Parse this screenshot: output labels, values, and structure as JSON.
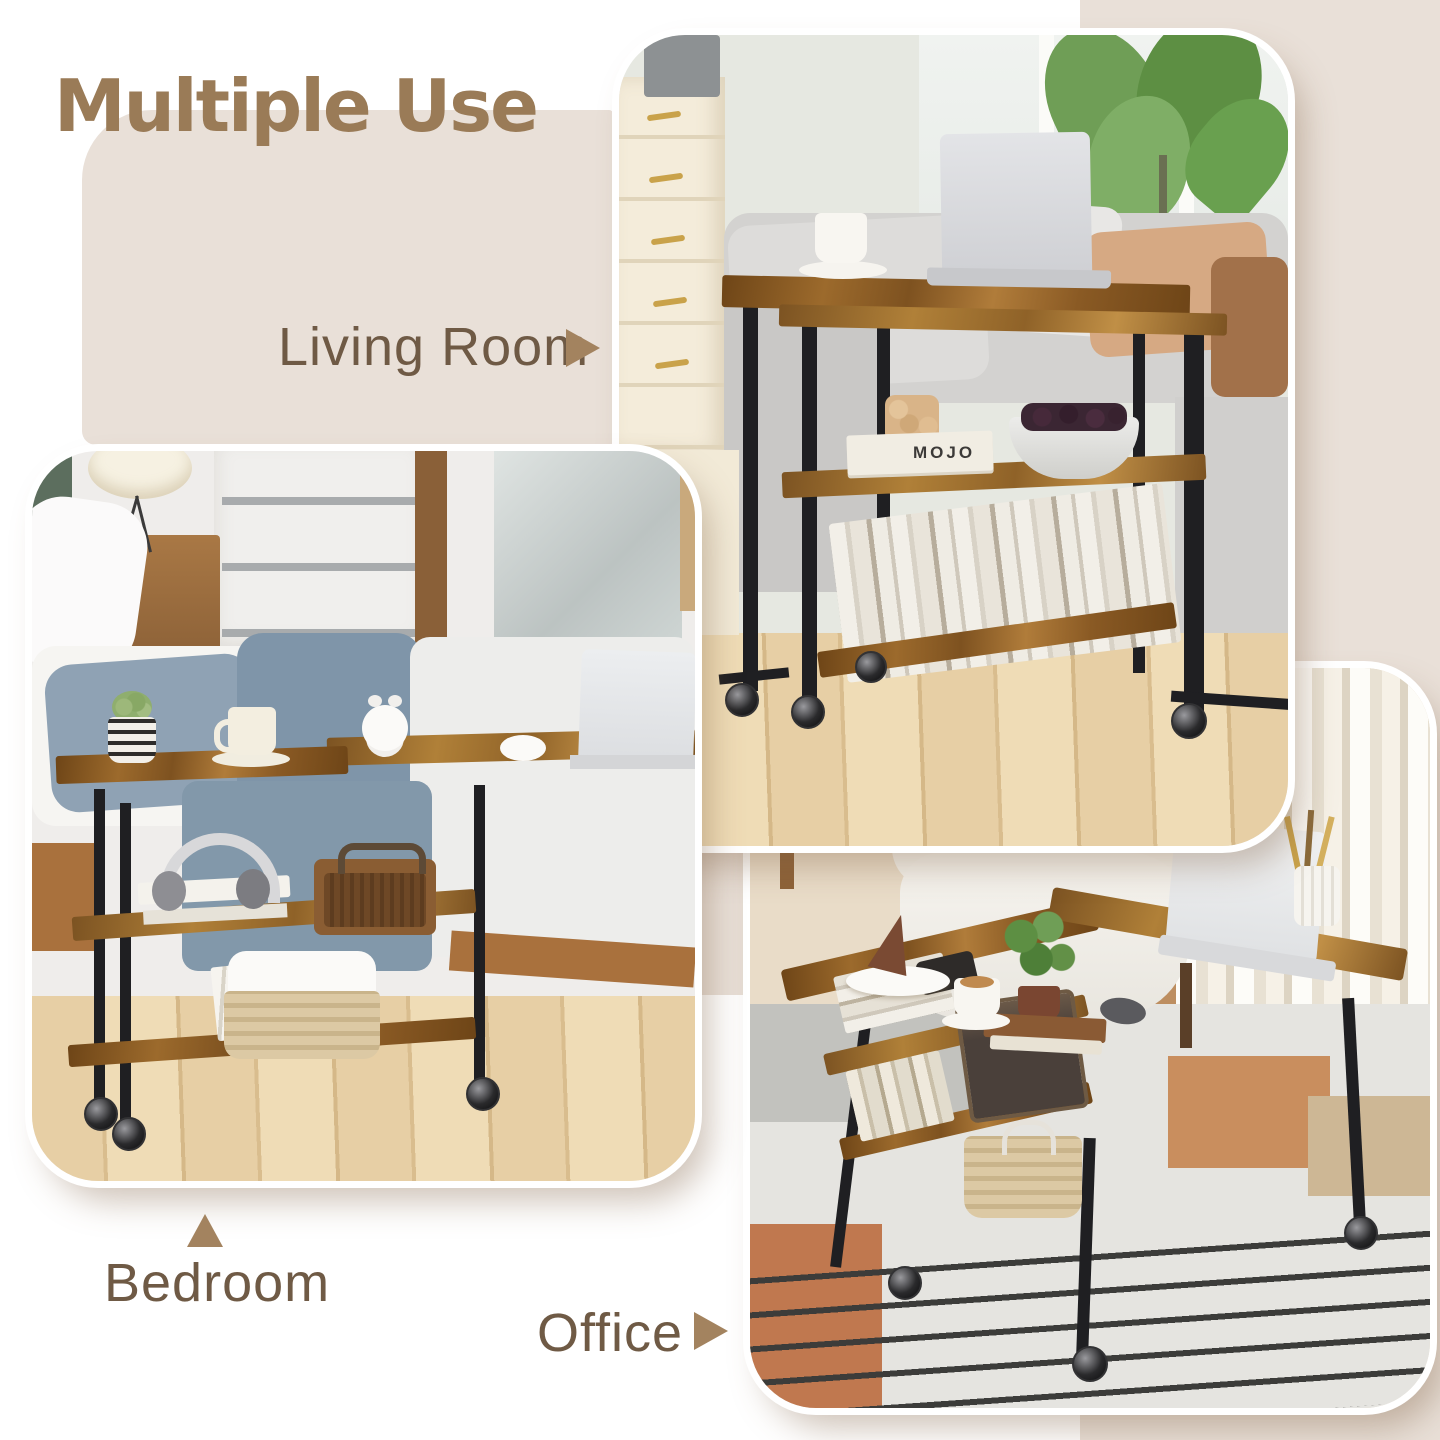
{
  "heading": {
    "text": "Multiple Use",
    "color": "#9a7b57"
  },
  "labels": {
    "living_room": {
      "text": "Living Room",
      "arrow": "right"
    },
    "bedroom": {
      "text": "Bedroom",
      "arrow": "up"
    },
    "office": {
      "text": "Office",
      "arrow": "right"
    },
    "text_color": "#6f5a45",
    "arrow_color": "#a3835f"
  },
  "panels": {
    "living_room": {
      "scene": "rotating sofa side table with laptop, coffee cup, book shelf behind gray sofa",
      "visible_text": {
        "book_title": "MOJO"
      }
    },
    "bedroom": {
      "scene": "swivel table rolled over bed with planter, mug, alarm clock, mouse and laptop"
    },
    "office": {
      "scene": "table rotated into L-shaped desk with laptop, coffee, cake and storage shelves"
    }
  },
  "palette": {
    "background": "#ffffff",
    "beige_blob": "#e9e0d8",
    "panel_stroke": "#ffffff",
    "rustic_wood": "#9c6a2c",
    "metal_frame": "#1f1f22"
  }
}
